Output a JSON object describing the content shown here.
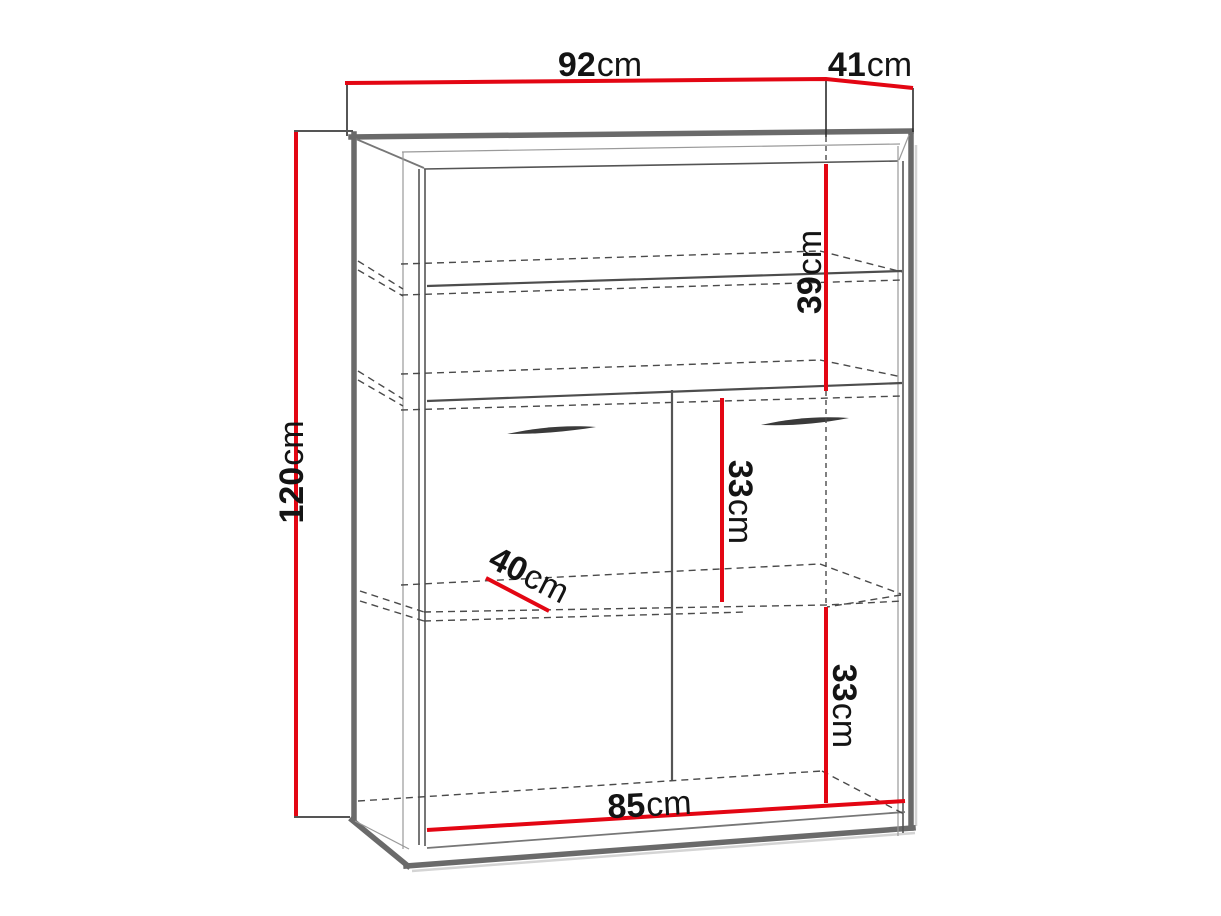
{
  "diagram": {
    "kind": "furniture-dimension-drawing",
    "object": "Two-door cabinet with two open shelves, perspective technical sketch",
    "background": "#ffffff",
    "colors": {
      "dimension_red": "#e30613",
      "frame_gray": "#6a6a6a",
      "hidden_line_gray": "#4a4a4a",
      "text": "#141414"
    },
    "labels": {
      "width": {
        "value": "92",
        "unit": "cm",
        "placement": "top"
      },
      "depth": {
        "value": "41",
        "unit": "cm",
        "placement": "top-right"
      },
      "height": {
        "value": "120",
        "unit": "cm",
        "placement": "left, rotated"
      },
      "upper_section_height": {
        "value": "39",
        "unit": "cm",
        "placement": "inside upper right, rotated"
      },
      "middle_section_height": {
        "value": "33",
        "unit": "cm",
        "placement": "inside middle, rotated"
      },
      "lower_section_height": {
        "value": "33",
        "unit": "cm",
        "placement": "inside lower right, rotated"
      },
      "shelf_depth": {
        "value": "40",
        "unit": "cm",
        "placement": "inside left, diagonal"
      },
      "inner_width": {
        "value": "85",
        "unit": "cm",
        "placement": "bottom"
      }
    }
  }
}
